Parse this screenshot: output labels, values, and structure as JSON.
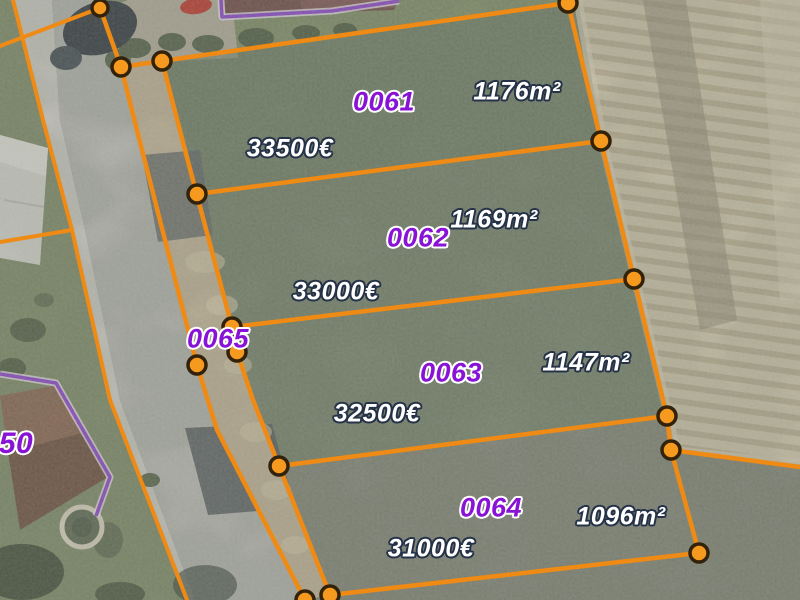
{
  "map": {
    "parcels": [
      {
        "id": "0061",
        "area": "1176m²",
        "price": "33500€"
      },
      {
        "id": "0062",
        "area": "1169m²",
        "price": "33000€"
      },
      {
        "id": "0063",
        "area": "1147m²",
        "price": "32500€"
      },
      {
        "id": "0064",
        "area": "1096m²",
        "price": "31000€"
      },
      {
        "id": "0065",
        "area": "",
        "price": ""
      },
      {
        "id": "50",
        "area": "",
        "price": ""
      }
    ],
    "colors": {
      "boundary_orange": "#ef8a14",
      "vertex_fill": "#f59a1e",
      "vertex_ring": "#33220a",
      "parcel_id_purple": "#8812d6",
      "id_halo_white": "#ffffff",
      "label_white": "#ffffff",
      "label_halo_dark": "#253247",
      "neighbor_boundary_purple": "#8c3fd0"
    }
  }
}
